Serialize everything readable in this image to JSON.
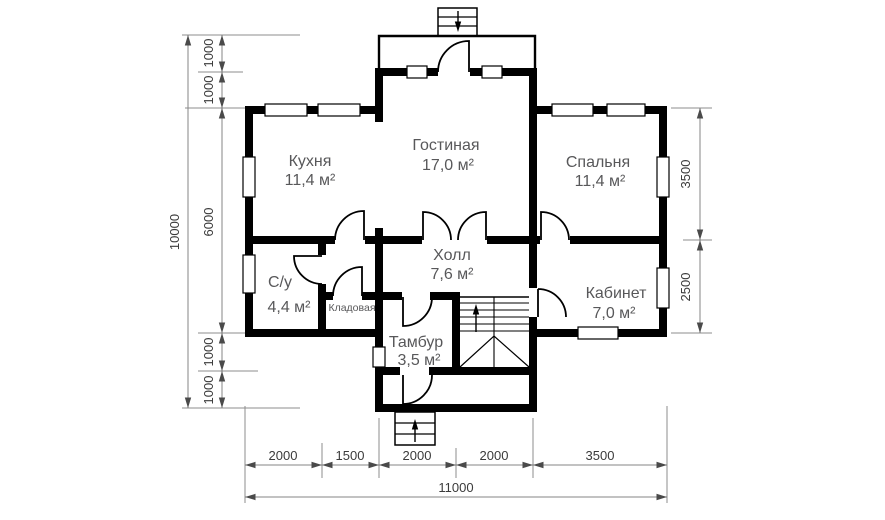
{
  "rooms": [
    {
      "name": "Кухня",
      "area": "11,4 м²"
    },
    {
      "name": "Гостиная",
      "area": "17,0 м²"
    },
    {
      "name": "Спальня",
      "area": "11,4 м²"
    },
    {
      "name": "Холл",
      "area": "7,6 м²"
    },
    {
      "name": "С/у",
      "area": "4,4 м²"
    },
    {
      "name": "Кладовая",
      "area": ""
    },
    {
      "name": "Тамбур",
      "area": "3,5 м²"
    },
    {
      "name": "Кабинет",
      "area": "7,0 м²"
    }
  ],
  "dimensions": {
    "left_outer": "10000",
    "left_chain": [
      "1000",
      "1000",
      "6000",
      "1000",
      "1000"
    ],
    "right_chain": [
      "3500",
      "2500"
    ],
    "bottom_chain": [
      "2000",
      "1500",
      "2000",
      "2000",
      "3500"
    ],
    "bottom_total": "11000"
  },
  "colors": {
    "wall": "#000000",
    "room_label": "#58585a",
    "dim_text": "#3b3b3b",
    "dim_line": "#858585",
    "background": "#ffffff"
  }
}
